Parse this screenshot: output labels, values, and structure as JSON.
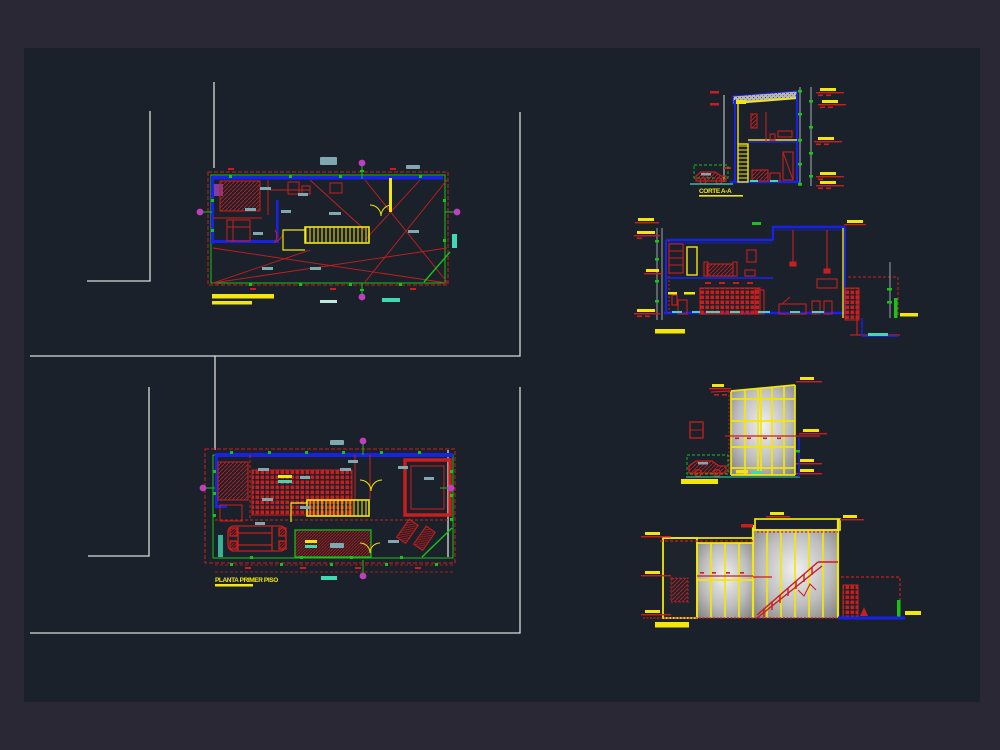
{
  "canvas": {
    "background_outer": "#2a2834",
    "background_inner": "#1a212a"
  },
  "palette": {
    "red": "#c81e1e",
    "dark_red": "#8e1414",
    "blue": "#1722e6",
    "yellow": "#f2e60c",
    "green": "#17c317",
    "teal": "#3fd9b4",
    "magenta": "#bf3fbf",
    "white_line": "#dcdcd8",
    "dim_gray": "#aab4b4",
    "text_blob": "#7fa8b0",
    "glass_light": "#efefef",
    "glass_dark": "#858585",
    "violet": "#7a3fa0"
  },
  "labels": {
    "plan_lower": "PLANTA PRIMER PISO",
    "section_aa": "CORTE A-A"
  }
}
